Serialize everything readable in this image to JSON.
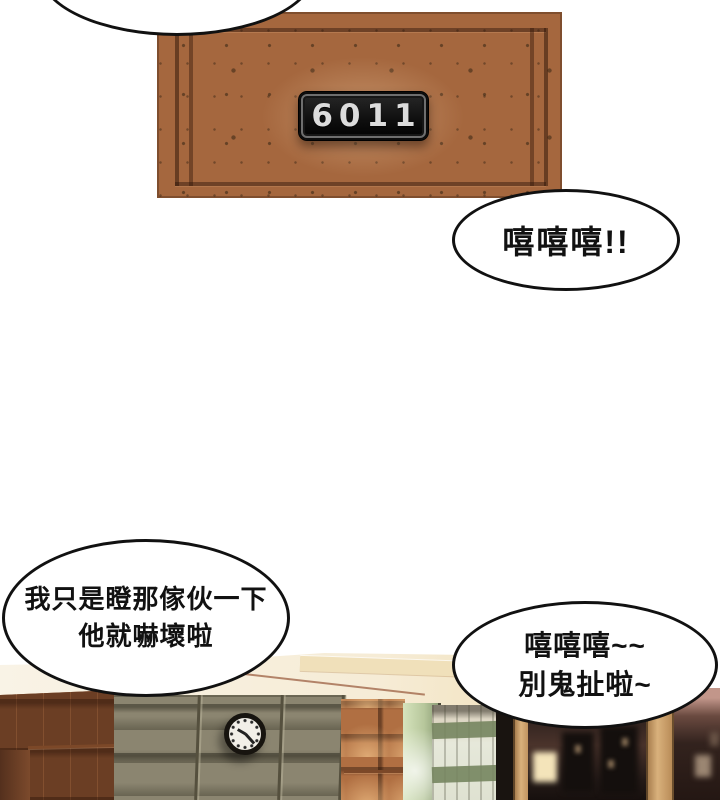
{
  "comic": {
    "door": {
      "room_number": "6011"
    },
    "bubbles": {
      "top_partial": {
        "text": ""
      },
      "giggle": {
        "text": "嘻嘻嘻!!"
      },
      "brag": {
        "line1": "我只是瞪那傢伙一下",
        "line2": "他就嚇壞啦"
      },
      "tease": {
        "line1": "嘻嘻嘻~~",
        "line2": "別鬼扯啦~"
      }
    },
    "colors": {
      "door_wood": "#a5673e",
      "sign_plate": "#141414",
      "sign_digits": "#dcdcdc",
      "tile_wall": "#ad6a3f",
      "stone_wall": "#8b8570",
      "curtain_stripe": "#75855f",
      "counter_cream": "#f7efdd",
      "bubble_fill": "#ffffff",
      "bubble_outline": "#111111"
    }
  }
}
